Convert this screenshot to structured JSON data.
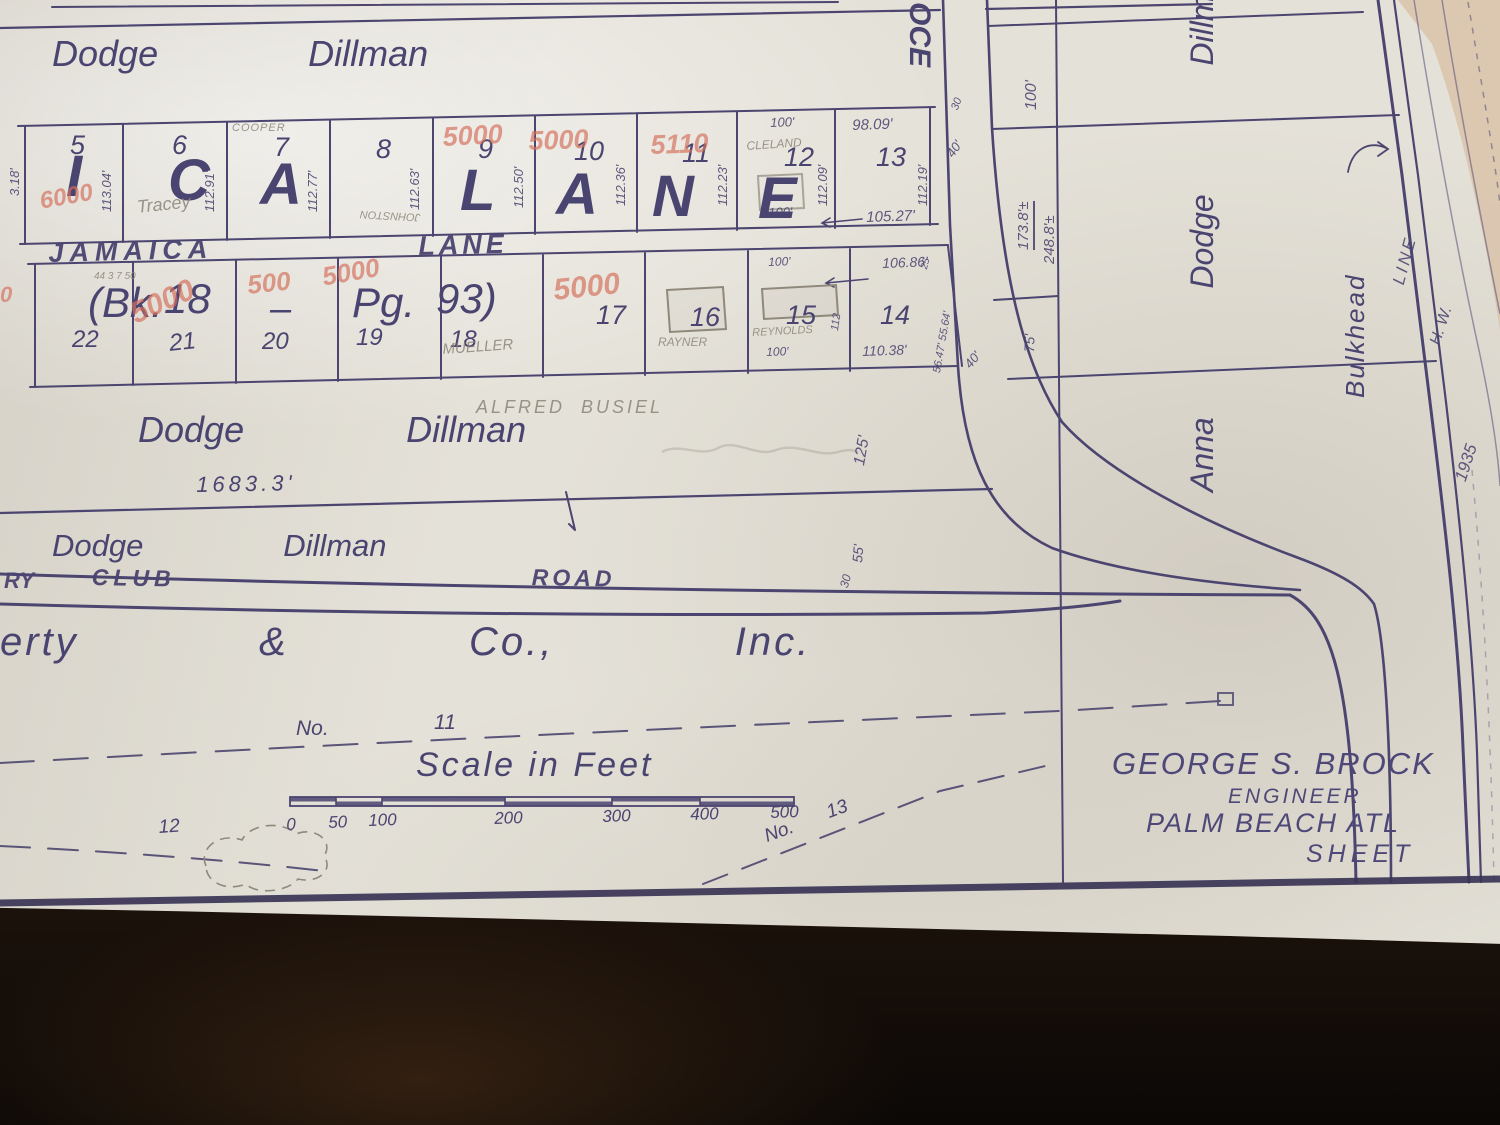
{
  "scene": {
    "description": "Photograph of a 1935 hand-drawn subdivision plat map on paper over a dark table",
    "paper_color": "#e4e1d8",
    "ink_color": "#4a4470",
    "red_pencil_color": "#d4705c",
    "graphite_color": "#8b8578",
    "sand_color": "#d9c1a8",
    "table_color": "#130d08"
  },
  "title_block": {
    "engineer_name": "GEORGE S. BROCK",
    "engineer_title": "ENGINEER",
    "location": "PALM BEACH ATL",
    "sheet_label": "SHEET"
  },
  "scale_bar": {
    "title": "Scale in Feet",
    "ticks": [
      "0",
      "50",
      "100",
      "200",
      "300",
      "400",
      "500"
    ]
  },
  "labels": [
    {
      "n": "owner-dodge-dillman-top",
      "t": "Dodge   Dillman",
      "x": 52,
      "y": 36,
      "fs": 36,
      "ws": 40,
      "cls": "hand"
    },
    {
      "n": "lane-big-letter",
      "t": "I",
      "x": 66,
      "y": 148,
      "fs": 58,
      "cls": "biglet"
    },
    {
      "n": "lane-big-letter",
      "t": "C",
      "x": 168,
      "y": 152,
      "fs": 58,
      "cls": "biglet"
    },
    {
      "n": "lane-big-letter",
      "t": "A",
      "x": 260,
      "y": 156,
      "fs": 58,
      "cls": "biglet"
    },
    {
      "n": "lane-big-letter",
      "t": "L",
      "x": 460,
      "y": 162,
      "fs": 58,
      "cls": "biglet"
    },
    {
      "n": "lane-big-letter",
      "t": "A",
      "x": 556,
      "y": 166,
      "fs": 58,
      "cls": "biglet"
    },
    {
      "n": "lane-big-letter",
      "t": "N",
      "x": 652,
      "y": 168,
      "fs": 58,
      "cls": "biglet"
    },
    {
      "n": "lane-big-letter",
      "t": "E",
      "x": 758,
      "y": 170,
      "fs": 58,
      "cls": "biglet"
    },
    {
      "n": "street-jamaica",
      "t": "JAMAICA",
      "x": 48,
      "y": 240,
      "fs": 27,
      "ls": 6,
      "rot": -1.5,
      "cls": "street"
    },
    {
      "n": "street-lane",
      "t": "LANE",
      "x": 418,
      "y": 233,
      "fs": 27,
      "ls": 4,
      "rot": -1.5,
      "cls": "street"
    },
    {
      "n": "lot-number",
      "t": "5",
      "x": 70,
      "y": 132,
      "fs": 27,
      "cls": "num"
    },
    {
      "n": "lot-number",
      "t": "6",
      "x": 172,
      "y": 132,
      "fs": 27,
      "cls": "num"
    },
    {
      "n": "lot-number",
      "t": "7",
      "x": 274,
      "y": 134,
      "fs": 27,
      "cls": "num"
    },
    {
      "n": "lot-number",
      "t": "8",
      "x": 376,
      "y": 136,
      "fs": 27,
      "cls": "num"
    },
    {
      "n": "lot-number",
      "t": "9",
      "x": 478,
      "y": 136,
      "fs": 27,
      "cls": "num"
    },
    {
      "n": "lot-number",
      "t": "10",
      "x": 574,
      "y": 138,
      "fs": 27,
      "cls": "num"
    },
    {
      "n": "lot-number",
      "t": "11",
      "x": 682,
      "y": 140,
      "fs": 27,
      "cls": "num"
    },
    {
      "n": "lot-number",
      "t": "12",
      "x": 784,
      "y": 144,
      "fs": 27,
      "cls": "num"
    },
    {
      "n": "lot-number",
      "t": "13",
      "x": 876,
      "y": 144,
      "fs": 27,
      "cls": "num"
    },
    {
      "n": "lot-measurement",
      "t": "3.18'",
      "x": 8,
      "y": 196,
      "fs": 13,
      "rot": -90,
      "cls": "meas"
    },
    {
      "n": "lot-measurement",
      "t": "113.04'",
      "x": 100,
      "y": 212,
      "fs": 13,
      "rot": -90,
      "cls": "meas"
    },
    {
      "n": "lot-measurement",
      "t": "112.91'",
      "x": 203,
      "y": 212,
      "fs": 13,
      "rot": -90,
      "cls": "meas"
    },
    {
      "n": "lot-measurement",
      "t": "112.77'",
      "x": 306,
      "y": 212,
      "fs": 13,
      "rot": -90,
      "cls": "meas"
    },
    {
      "n": "lot-measurement",
      "t": "112.63'",
      "x": 408,
      "y": 210,
      "fs": 13,
      "rot": -90,
      "cls": "meas"
    },
    {
      "n": "lot-measurement",
      "t": "112.50'",
      "x": 512,
      "y": 208,
      "fs": 13,
      "rot": -90,
      "cls": "meas"
    },
    {
      "n": "lot-measurement",
      "t": "112.36'",
      "x": 614,
      "y": 206,
      "fs": 13,
      "rot": -90,
      "cls": "meas"
    },
    {
      "n": "lot-measurement",
      "t": "112.23'",
      "x": 716,
      "y": 206,
      "fs": 13,
      "rot": -90,
      "cls": "meas"
    },
    {
      "n": "lot-measurement",
      "t": "112.09'",
      "x": 816,
      "y": 206,
      "fs": 13,
      "rot": -90,
      "cls": "meas"
    },
    {
      "n": "lot-measurement",
      "t": "112.19'",
      "x": 916,
      "y": 206,
      "fs": 13,
      "rot": -90,
      "cls": "meas"
    },
    {
      "n": "lot-measurement",
      "t": "98.09'",
      "x": 852,
      "y": 118,
      "fs": 15,
      "rot": -2,
      "cls": "meas"
    },
    {
      "n": "lot-measurement",
      "t": "100'",
      "x": 770,
      "y": 116,
      "fs": 13,
      "rot": -2,
      "cls": "meas"
    },
    {
      "n": "lot-measurement",
      "t": "100'",
      "x": 768,
      "y": 206,
      "fs": 13,
      "rot": -2,
      "cls": "meas"
    },
    {
      "n": "lot-measurement",
      "t": "105.27'",
      "x": 866,
      "y": 210,
      "fs": 15,
      "rot": -2,
      "cls": "meas"
    },
    {
      "n": "penciled-owner",
      "t": "COOPER",
      "x": 232,
      "y": 123,
      "fs": 11,
      "ls": 1,
      "cls": "pencil"
    },
    {
      "n": "penciled-owner",
      "t": "JOHNSTON",
      "x": 420,
      "y": 222,
      "fs": 11,
      "rot": 183,
      "cls": "pencil"
    },
    {
      "n": "penciled-owner",
      "t": "CLELAND",
      "x": 746,
      "y": 140,
      "fs": 12,
      "rot": -4,
      "cls": "pencil"
    },
    {
      "n": "penciled-owner",
      "t": "Tracey",
      "x": 136,
      "y": 198,
      "fs": 18,
      "rot": -6,
      "cls": "pencil"
    },
    {
      "n": "red-price-note",
      "t": "6000",
      "x": 38,
      "y": 190,
      "fs": 24,
      "rot": -10,
      "cls": "red"
    },
    {
      "n": "red-price-note",
      "t": "5000",
      "x": 442,
      "y": 124,
      "fs": 27,
      "rot": -3,
      "cls": "red"
    },
    {
      "n": "red-price-note",
      "t": "5000",
      "x": 528,
      "y": 128,
      "fs": 27,
      "rot": -2,
      "cls": "red"
    },
    {
      "n": "red-price-note",
      "t": "5110",
      "x": 650,
      "y": 132,
      "fs": 27,
      "rot": -2,
      "cls": "red"
    },
    {
      "n": "plat-book-ref",
      "t": "(Bk.",
      "x": 88,
      "y": 282,
      "fs": 42,
      "cls": "hand"
    },
    {
      "n": "plat-book-ref",
      "t": "18",
      "x": 164,
      "y": 278,
      "fs": 42,
      "cls": "hand"
    },
    {
      "n": "plat-book-ref",
      "t": "–",
      "x": 270,
      "y": 290,
      "fs": 38,
      "cls": "hand"
    },
    {
      "n": "plat-book-ref",
      "t": "Pg.",
      "x": 352,
      "y": 282,
      "fs": 42,
      "cls": "hand"
    },
    {
      "n": "plat-book-ref",
      "t": "93)",
      "x": 436,
      "y": 278,
      "fs": 42,
      "cls": "hand"
    },
    {
      "n": "penciled-note",
      "t": "44 3 7 50",
      "x": 94,
      "y": 272,
      "fs": 10,
      "cls": "pencil"
    },
    {
      "n": "lot-number",
      "t": "22",
      "x": 72,
      "y": 328,
      "fs": 24,
      "cls": "num"
    },
    {
      "n": "lot-number",
      "t": "21",
      "x": 168,
      "y": 332,
      "fs": 24,
      "rot": -6,
      "cls": "num"
    },
    {
      "n": "lot-number",
      "t": "20",
      "x": 262,
      "y": 330,
      "fs": 24,
      "cls": "num"
    },
    {
      "n": "lot-number",
      "t": "19",
      "x": 356,
      "y": 326,
      "fs": 24,
      "cls": "num"
    },
    {
      "n": "lot-number",
      "t": "18",
      "x": 450,
      "y": 328,
      "fs": 24,
      "cls": "num"
    },
    {
      "n": "lot-number",
      "t": "17",
      "x": 596,
      "y": 302,
      "fs": 27,
      "cls": "num"
    },
    {
      "n": "lot-number",
      "t": "16",
      "x": 690,
      "y": 304,
      "fs": 27,
      "cls": "num"
    },
    {
      "n": "lot-number",
      "t": "15",
      "x": 786,
      "y": 302,
      "fs": 27,
      "cls": "num"
    },
    {
      "n": "lot-number",
      "t": "14",
      "x": 880,
      "y": 302,
      "fs": 27,
      "cls": "num"
    },
    {
      "n": "red-price-note",
      "t": "5000",
      "x": 126,
      "y": 302,
      "fs": 30,
      "rot": -24,
      "cls": "red"
    },
    {
      "n": "red-price-note",
      "t": "500",
      "x": 246,
      "y": 272,
      "fs": 26,
      "rot": -6,
      "cls": "red"
    },
    {
      "n": "red-price-note",
      "t": "5000",
      "x": 320,
      "y": 264,
      "fs": 26,
      "rot": -10,
      "cls": "red"
    },
    {
      "n": "red-price-note",
      "t": "5000",
      "x": 552,
      "y": 276,
      "fs": 30,
      "rot": -6,
      "cls": "red"
    },
    {
      "n": "red-price-note",
      "t": "0",
      "x": 0,
      "y": 284,
      "fs": 22,
      "cls": "red"
    },
    {
      "n": "penciled-owner",
      "t": "MUELLER",
      "x": 442,
      "y": 342,
      "fs": 15,
      "rot": -4,
      "cls": "pencil"
    },
    {
      "n": "penciled-owner",
      "t": "RAYNER",
      "x": 658,
      "y": 336,
      "fs": 12,
      "cls": "pencil"
    },
    {
      "n": "penciled-owner",
      "t": "REYNOLDS",
      "x": 752,
      "y": 328,
      "fs": 11,
      "rot": -3,
      "cls": "pencil"
    },
    {
      "n": "lot-measurement",
      "t": "100'",
      "x": 768,
      "y": 256,
      "fs": 12,
      "rot": -2,
      "cls": "meas"
    },
    {
      "n": "lot-measurement",
      "t": "100'",
      "x": 766,
      "y": 346,
      "fs": 12,
      "rot": -2,
      "cls": "meas"
    },
    {
      "n": "lot-measurement",
      "t": "112",
      "x": 830,
      "y": 330,
      "fs": 11,
      "rot": -82,
      "cls": "meas"
    },
    {
      "n": "lot-measurement",
      "t": "106.86'",
      "x": 882,
      "y": 256,
      "fs": 14,
      "rot": -2,
      "cls": "meas"
    },
    {
      "n": "lot-measurement",
      "t": "110.38'",
      "x": 862,
      "y": 344,
      "fs": 14,
      "rot": -2,
      "cls": "meas"
    },
    {
      "n": "lot-measurement",
      "t": "56.47' 55.64'",
      "x": 932,
      "y": 372,
      "fs": 11,
      "rot": -80,
      "cls": "meas"
    },
    {
      "n": "lot-measurement",
      "t": "25",
      "x": 920,
      "y": 268,
      "fs": 10,
      "rot": -75,
      "cls": "meas"
    },
    {
      "n": "street-ocean",
      "t": "OCE",
      "x": 934,
      "y": 2,
      "fs": 30,
      "rot": 90,
      "cls": "biglet"
    },
    {
      "n": "road-width",
      "t": "30",
      "x": 950,
      "y": 108,
      "fs": 11,
      "rot": -70,
      "cls": "meas"
    },
    {
      "n": "road-width",
      "t": "40'",
      "x": 944,
      "y": 152,
      "fs": 13,
      "rot": -55,
      "cls": "meas"
    },
    {
      "n": "road-width",
      "t": "40'",
      "x": 962,
      "y": 362,
      "fs": 13,
      "rot": -50,
      "cls": "meas"
    },
    {
      "n": "block-measurement",
      "t": "100'",
      "x": 1024,
      "y": 110,
      "fs": 16,
      "rot": -90,
      "cls": "meas"
    },
    {
      "n": "block-measurement",
      "t": "173.8'±",
      "x": 1016,
      "y": 250,
      "fs": 15,
      "rot": -90,
      "cls": "meas underln"
    },
    {
      "n": "block-measurement",
      "t": "248.8'±",
      "x": 1042,
      "y": 264,
      "fs": 15,
      "rot": -90,
      "cls": "meas"
    },
    {
      "n": "block-measurement",
      "t": "75'",
      "x": 1022,
      "y": 352,
      "fs": 14,
      "rot": -88,
      "cls": "meas"
    },
    {
      "n": "block-measurement",
      "t": "125'",
      "x": 852,
      "y": 464,
      "fs": 16,
      "rot": -80,
      "cls": "meas"
    },
    {
      "n": "block-measurement",
      "t": "55'",
      "x": 850,
      "y": 562,
      "fs": 14,
      "rot": -85,
      "cls": "meas"
    },
    {
      "n": "block-measurement",
      "t": "30",
      "x": 838,
      "y": 586,
      "fs": 12,
      "rot": -75,
      "cls": "meas"
    },
    {
      "n": "owner-anna-dodge-dillman",
      "t": "Anna   Dodge   Dillman",
      "x": 1186,
      "y": 492,
      "fs": 32,
      "ws": 34,
      "rot": -90,
      "cls": "hand"
    },
    {
      "n": "bulkhead-label",
      "t": "Bulkhead",
      "x": 1342,
      "y": 398,
      "fs": 26,
      "ls": 2,
      "rot": -90,
      "cls": "hand"
    },
    {
      "n": "hw-line-label",
      "t": "LINE",
      "x": 1390,
      "y": 282,
      "fs": 17,
      "ls": 3,
      "rot": -75,
      "cls": "meas"
    },
    {
      "n": "hw-line-label",
      "t": "H. W.",
      "x": 1428,
      "y": 342,
      "fs": 16,
      "rot": -72,
      "cls": "meas"
    },
    {
      "n": "hw-line-label",
      "t": "1935",
      "x": 1452,
      "y": 478,
      "fs": 17,
      "rot": -72,
      "cls": "meas"
    },
    {
      "n": "penciled-owner",
      "t": "ALFRED  BUSIEL",
      "x": 476,
      "y": 398,
      "fs": 18,
      "ls": 3,
      "cls": "pencil"
    },
    {
      "n": "owner-dodge-dillman-middle",
      "t": "Dodge   Dillman",
      "x": 138,
      "y": 412,
      "fs": 36,
      "ws": 44,
      "cls": "hand"
    },
    {
      "n": "frontage-measurement",
      "t": "1683.3'",
      "x": 196,
      "y": 474,
      "fs": 22,
      "ls": 4,
      "rot": -1,
      "cls": "num"
    },
    {
      "n": "owner-dodge-dillman-lower",
      "t": "Dodge   Dillman",
      "x": 52,
      "y": 530,
      "fs": 31,
      "ws": 38,
      "cls": "hand"
    },
    {
      "n": "street-country-club-partial",
      "t": "RY",
      "x": 4,
      "y": 570,
      "fs": 22,
      "cls": "street"
    },
    {
      "n": "street-country-club",
      "t": "CLUB",
      "x": 92,
      "y": 566,
      "fs": 23,
      "ls": 5,
      "rot": 1,
      "cls": "street"
    },
    {
      "n": "street-road",
      "t": "ROAD",
      "x": 532,
      "y": 566,
      "fs": 23,
      "ls": 4,
      "rot": 1,
      "cls": "street"
    },
    {
      "n": "owner-company-partial",
      "t": "erty   &   Co.,   Inc.",
      "x": 0,
      "y": 622,
      "fs": 40,
      "ls": 3,
      "ws": 46,
      "cls": "hand"
    },
    {
      "n": "survey-line-label",
      "t": "No.",
      "x": 296,
      "y": 718,
      "fs": 21,
      "cls": "num"
    },
    {
      "n": "survey-line-label",
      "t": "11",
      "x": 434,
      "y": 712,
      "fs": 21,
      "cls": "num"
    },
    {
      "n": "scale-title",
      "t": "Scale in Feet",
      "x": 416,
      "y": 748,
      "fs": 34,
      "cls": "hand2"
    },
    {
      "n": "scale-tick",
      "t": "0",
      "x": 286,
      "y": 816,
      "fs": 17,
      "rot": -2,
      "cls": "num"
    },
    {
      "n": "scale-tick",
      "t": "50",
      "x": 328,
      "y": 814,
      "fs": 17,
      "rot": -2,
      "cls": "num"
    },
    {
      "n": "scale-tick",
      "t": "100",
      "x": 368,
      "y": 812,
      "fs": 17,
      "rot": -2,
      "cls": "num"
    },
    {
      "n": "scale-tick",
      "t": "200",
      "x": 494,
      "y": 810,
      "fs": 17,
      "rot": -2,
      "cls": "num"
    },
    {
      "n": "scale-tick",
      "t": "300",
      "x": 602,
      "y": 808,
      "fs": 17,
      "rot": -2,
      "cls": "num"
    },
    {
      "n": "scale-tick",
      "t": "400",
      "x": 690,
      "y": 806,
      "fs": 17,
      "rot": -2,
      "cls": "num"
    },
    {
      "n": "scale-tick",
      "t": "500",
      "x": 770,
      "y": 804,
      "fs": 17,
      "rot": -2,
      "cls": "num"
    },
    {
      "n": "survey-line-label",
      "t": "No.",
      "x": 762,
      "y": 828,
      "fs": 19,
      "rot": -20,
      "cls": "num"
    },
    {
      "n": "survey-line-label",
      "t": "13",
      "x": 824,
      "y": 804,
      "fs": 19,
      "rot": -20,
      "cls": "num"
    },
    {
      "n": "survey-line-label",
      "t": "12",
      "x": 158,
      "y": 818,
      "fs": 19,
      "rot": -4,
      "cls": "num"
    },
    {
      "n": "engineer-name",
      "t": "GEORGE S. BROCK",
      "x": 1112,
      "y": 748,
      "fs": 31,
      "ls": 2,
      "cls": "title"
    },
    {
      "n": "engineer-title",
      "t": "ENGINEER",
      "x": 1228,
      "y": 786,
      "fs": 21,
      "ls": 3,
      "cls": "title"
    },
    {
      "n": "map-location",
      "t": "PALM BEACH ATL",
      "x": 1146,
      "y": 810,
      "fs": 27,
      "ls": 2,
      "cls": "title"
    },
    {
      "n": "sheet-label",
      "t": "SHEET",
      "x": 1306,
      "y": 842,
      "fs": 25,
      "ls": 5,
      "cls": "title"
    }
  ]
}
